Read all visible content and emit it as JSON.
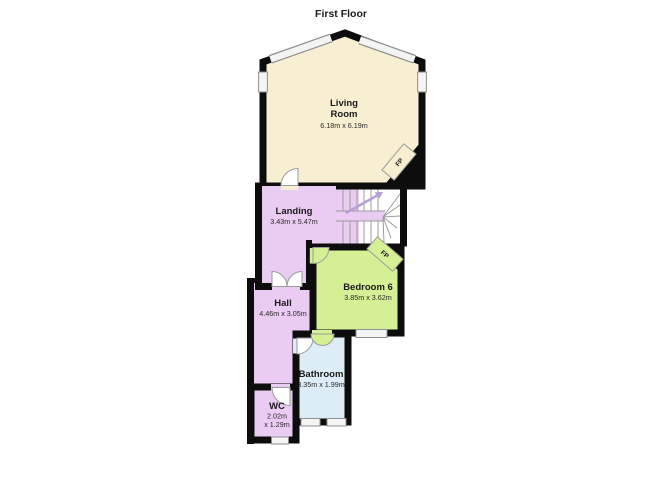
{
  "title": "First Floor",
  "rooms": {
    "living_room": {
      "name_line1": "Living",
      "name_line2": "Room",
      "dims": "6.18m x 6.19m",
      "color": "#f8efd3"
    },
    "landing": {
      "name": "Landing",
      "dims": "3.43m x 5.47m",
      "color": "#eaccf2"
    },
    "bedroom6": {
      "name": "Bedroom 6",
      "dims": "3.85m x 3.62m",
      "color": "#d5f094"
    },
    "hall": {
      "name": "Hall",
      "dims": "4.46m x 3.05m",
      "color": "#eaccf2"
    },
    "bathroom": {
      "name": "Bathroom",
      "dims": "3.35m x 1.99m",
      "color": "#dcedf8"
    },
    "wc": {
      "name": "WC",
      "dims_line1": "2.02m",
      "dims_line2": "x 1.29m",
      "color": "#eaccf2"
    }
  },
  "fireplaces": {
    "living_room": "FP",
    "bedroom6": "FP"
  },
  "palette": {
    "wall": "#0d0d0d",
    "window_fill": "#f4f4f4",
    "window_stroke": "#8f8f8f",
    "door_stroke": "#9a9a9a",
    "stair_line": "#9a9a9a",
    "arrow": "#b4a0d4",
    "background": "#ffffff"
  }
}
